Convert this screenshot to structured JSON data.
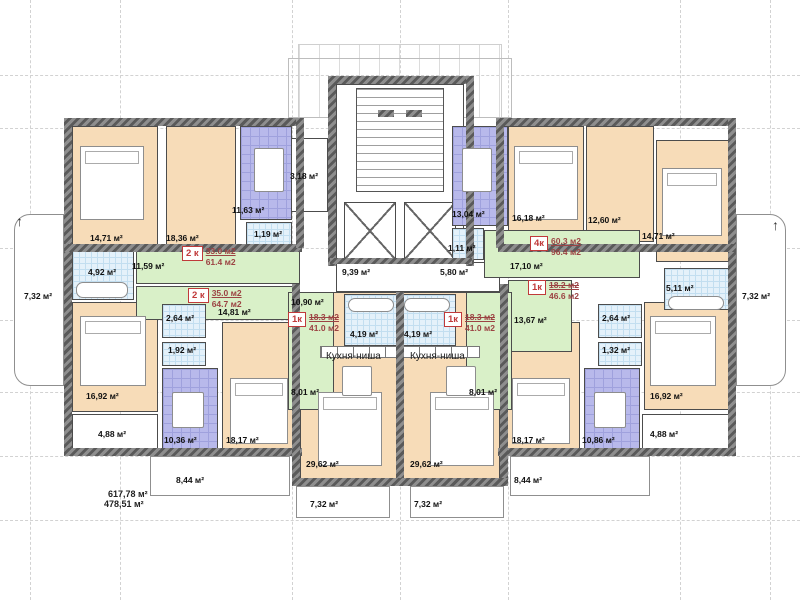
{
  "palette": {
    "room": "#f7dcb8",
    "kitchen": "#b8b9eb",
    "hall": "#d9f0c8",
    "bath": "#e4f1fa",
    "wall": "#5a5a5a",
    "badge_red": "#c03a3a",
    "badge_value": "#9c4343"
  },
  "grid": {
    "v": [
      30,
      120,
      292,
      400,
      508,
      680,
      770
    ],
    "h": [
      75,
      128,
      248,
      320,
      392,
      456,
      520
    ]
  },
  "regions": [
    {
      "name": "entrance-canopy-mullions",
      "f": "mull",
      "x": 298,
      "y": 44,
      "w": 204,
      "h": 74
    },
    {
      "name": "entrance-canopy-outline",
      "f": "out",
      "x": 288,
      "y": 58,
      "w": 224,
      "h": 60
    },
    {
      "name": "stairwell",
      "f": "white",
      "x": 336,
      "y": 84,
      "w": 128,
      "h": 176
    },
    {
      "name": "stairs",
      "f": "stairs",
      "x": 356,
      "y": 88,
      "w": 88,
      "h": 104
    },
    {
      "name": "elevator-left",
      "f": "lift",
      "x": 344,
      "y": 202,
      "w": 52,
      "h": 58
    },
    {
      "name": "elevator-right",
      "f": "lift",
      "x": 404,
      "y": 202,
      "w": 52,
      "h": 58
    },
    {
      "name": "elevator-lobby",
      "f": "white",
      "x": 336,
      "y": 262,
      "w": 164,
      "h": 30
    },
    {
      "name": "vestibule-318",
      "f": "white",
      "x": 288,
      "y": 138,
      "w": 40,
      "h": 74
    },
    {
      "name": "bedroom-1471-left",
      "f": "peach",
      "x": 72,
      "y": 126,
      "w": 86,
      "h": 122
    },
    {
      "name": "living-1836",
      "f": "peach",
      "x": 166,
      "y": 126,
      "w": 70,
      "h": 122
    },
    {
      "name": "bedroom-1692-left",
      "f": "peach",
      "x": 72,
      "y": 302,
      "w": 86,
      "h": 110
    },
    {
      "name": "bedroom-1817-left",
      "f": "peach",
      "x": 222,
      "y": 322,
      "w": 74,
      "h": 128
    },
    {
      "name": "bedroom-1618",
      "f": "peach",
      "x": 508,
      "y": 126,
      "w": 76,
      "h": 116
    },
    {
      "name": "bedroom-1260",
      "f": "peach",
      "x": 586,
      "y": 126,
      "w": 68,
      "h": 116
    },
    {
      "name": "bedroom-1471-right",
      "f": "peach",
      "x": 656,
      "y": 140,
      "w": 74,
      "h": 122
    },
    {
      "name": "bedroom-1692-right",
      "f": "peach",
      "x": 644,
      "y": 302,
      "w": 86,
      "h": 108
    },
    {
      "name": "bedroom-1817-right",
      "f": "peach",
      "x": 506,
      "y": 322,
      "w": 74,
      "h": 128
    },
    {
      "name": "living-2962-left",
      "f": "peach",
      "x": 300,
      "y": 292,
      "w": 98,
      "h": 192
    },
    {
      "name": "living-2962-right",
      "f": "peach",
      "x": 402,
      "y": 292,
      "w": 98,
      "h": 192
    },
    {
      "name": "hall-1159",
      "f": "green",
      "x": 136,
      "y": 250,
      "w": 164,
      "h": 34
    },
    {
      "name": "hall-1481",
      "f": "green",
      "x": 136,
      "y": 286,
      "w": 164,
      "h": 34
    },
    {
      "name": "hall-1710",
      "f": "green",
      "x": 484,
      "y": 230,
      "w": 156,
      "h": 48
    },
    {
      "name": "hall-1367",
      "f": "green",
      "x": 508,
      "y": 280,
      "w": 64,
      "h": 72
    },
    {
      "name": "hall-center-left",
      "f": "green",
      "x": 288,
      "y": 292,
      "w": 46,
      "h": 118
    },
    {
      "name": "hall-center-right",
      "f": "green",
      "x": 466,
      "y": 292,
      "w": 46,
      "h": 118
    },
    {
      "name": "kitchen-1163",
      "f": "blue",
      "x": 240,
      "y": 126,
      "w": 52,
      "h": 94
    },
    {
      "name": "kitchen-1036",
      "f": "blue",
      "x": 162,
      "y": 368,
      "w": 56,
      "h": 84
    },
    {
      "name": "kitchen-1304",
      "f": "blue",
      "x": 452,
      "y": 126,
      "w": 56,
      "h": 100
    },
    {
      "name": "kitchen-1086",
      "f": "blue",
      "x": 584,
      "y": 368,
      "w": 56,
      "h": 84
    },
    {
      "name": "bath-119",
      "f": "tile",
      "x": 246,
      "y": 222,
      "w": 46,
      "h": 28
    },
    {
      "name": "bath-492",
      "f": "tile",
      "x": 72,
      "y": 250,
      "w": 62,
      "h": 50
    },
    {
      "name": "wc-264-left",
      "f": "tile",
      "x": 162,
      "y": 304,
      "w": 44,
      "h": 34
    },
    {
      "name": "wc-192",
      "f": "tile",
      "x": 162,
      "y": 342,
      "w": 44,
      "h": 24
    },
    {
      "name": "bath-111",
      "f": "tile",
      "x": 452,
      "y": 228,
      "w": 32,
      "h": 32
    },
    {
      "name": "bath-419-left",
      "f": "tile",
      "x": 344,
      "y": 294,
      "w": 56,
      "h": 52
    },
    {
      "name": "bath-419-right",
      "f": "tile",
      "x": 400,
      "y": 294,
      "w": 56,
      "h": 52
    },
    {
      "name": "bath-511",
      "f": "tile",
      "x": 664,
      "y": 268,
      "w": 66,
      "h": 42
    },
    {
      "name": "wc-264-right",
      "f": "tile",
      "x": 598,
      "y": 304,
      "w": 44,
      "h": 34
    },
    {
      "name": "wc-132",
      "f": "tile",
      "x": 598,
      "y": 342,
      "w": 44,
      "h": 24
    },
    {
      "name": "loggia-488-left",
      "f": "white",
      "x": 72,
      "y": 414,
      "w": 86,
      "h": 38
    },
    {
      "name": "loggia-488-right",
      "f": "white",
      "x": 642,
      "y": 414,
      "w": 88,
      "h": 38
    },
    {
      "name": "balcony-side-left",
      "f": "balc",
      "x": 14,
      "y": 214,
      "w": 50,
      "h": 172,
      "r": "16px 0 0 16px"
    },
    {
      "name": "balcony-side-right",
      "f": "balc",
      "x": 736,
      "y": 214,
      "w": 50,
      "h": 172,
      "r": "0 16px 16px 0"
    },
    {
      "name": "balcony-844-left",
      "f": "balc",
      "x": 150,
      "y": 456,
      "w": 140,
      "h": 40
    },
    {
      "name": "balcony-844-right",
      "f": "balc",
      "x": 510,
      "y": 456,
      "w": 140,
      "h": 40
    },
    {
      "name": "balcony-732-left",
      "f": "balc",
      "x": 296,
      "y": 486,
      "w": 94,
      "h": 32
    },
    {
      "name": "balcony-732-right",
      "f": "balc",
      "x": 410,
      "y": 486,
      "w": 94,
      "h": 32
    },
    {
      "name": "kitchen-niche-counter-left",
      "f": "counter",
      "x": 320,
      "y": 346,
      "w": 78,
      "h": 12
    },
    {
      "name": "kitchen-niche-counter-right",
      "f": "counter",
      "x": 402,
      "y": 346,
      "w": 78,
      "h": 12
    }
  ],
  "walls": [
    {
      "x": 64,
      "y": 118,
      "w": 240,
      "h": 8
    },
    {
      "x": 496,
      "y": 118,
      "w": 240,
      "h": 8
    },
    {
      "x": 64,
      "y": 118,
      "w": 8,
      "h": 338
    },
    {
      "x": 728,
      "y": 118,
      "w": 8,
      "h": 338
    },
    {
      "x": 64,
      "y": 448,
      "w": 238,
      "h": 8
    },
    {
      "x": 498,
      "y": 448,
      "w": 238,
      "h": 8
    },
    {
      "x": 64,
      "y": 244,
      "w": 238,
      "h": 8
    },
    {
      "x": 498,
      "y": 244,
      "w": 238,
      "h": 8
    },
    {
      "x": 328,
      "y": 76,
      "w": 146,
      "h": 8
    },
    {
      "x": 328,
      "y": 76,
      "w": 8,
      "h": 190
    },
    {
      "x": 466,
      "y": 76,
      "w": 8,
      "h": 190
    },
    {
      "x": 330,
      "y": 258,
      "w": 142,
      "h": 6
    },
    {
      "x": 292,
      "y": 284,
      "w": 8,
      "h": 202
    },
    {
      "x": 500,
      "y": 284,
      "w": 8,
      "h": 202
    },
    {
      "x": 396,
      "y": 292,
      "w": 8,
      "h": 194
    },
    {
      "x": 292,
      "y": 478,
      "w": 216,
      "h": 8
    },
    {
      "x": 296,
      "y": 118,
      "w": 8,
      "h": 130
    },
    {
      "x": 496,
      "y": 118,
      "w": 8,
      "h": 130
    },
    {
      "x": 378,
      "y": 110,
      "w": 16,
      "h": 7
    },
    {
      "x": 406,
      "y": 110,
      "w": 16,
      "h": 7
    }
  ],
  "furniture": [
    {
      "t": "bed",
      "x": 80,
      "y": 146,
      "w": 64,
      "h": 74
    },
    {
      "t": "bed",
      "x": 80,
      "y": 316,
      "w": 66,
      "h": 70
    },
    {
      "t": "bed",
      "x": 230,
      "y": 378,
      "w": 58,
      "h": 66
    },
    {
      "t": "bed",
      "x": 514,
      "y": 146,
      "w": 64,
      "h": 74
    },
    {
      "t": "bed",
      "x": 662,
      "y": 168,
      "w": 60,
      "h": 68
    },
    {
      "t": "bed",
      "x": 650,
      "y": 316,
      "w": 66,
      "h": 70
    },
    {
      "t": "bed",
      "x": 512,
      "y": 378,
      "w": 58,
      "h": 66
    },
    {
      "t": "bed",
      "x": 318,
      "y": 392,
      "w": 64,
      "h": 74
    },
    {
      "t": "bed",
      "x": 430,
      "y": 392,
      "w": 64,
      "h": 74
    },
    {
      "t": "table",
      "x": 254,
      "y": 148,
      "w": 30,
      "h": 44
    },
    {
      "t": "table",
      "x": 462,
      "y": 148,
      "w": 30,
      "h": 44
    },
    {
      "t": "table",
      "x": 172,
      "y": 392,
      "w": 32,
      "h": 36
    },
    {
      "t": "table",
      "x": 594,
      "y": 392,
      "w": 32,
      "h": 36
    },
    {
      "t": "table",
      "x": 342,
      "y": 366,
      "w": 30,
      "h": 30
    },
    {
      "t": "table",
      "x": 446,
      "y": 366,
      "w": 30,
      "h": 30
    },
    {
      "t": "tub",
      "x": 76,
      "y": 282,
      "w": 52,
      "h": 16
    },
    {
      "t": "tub",
      "x": 668,
      "y": 296,
      "w": 56,
      "h": 14
    },
    {
      "t": "tub",
      "x": 348,
      "y": 298,
      "w": 46,
      "h": 14
    },
    {
      "t": "tub",
      "x": 404,
      "y": 298,
      "w": 46,
      "h": 14
    }
  ],
  "labels": [
    {
      "t": "14,71 м²",
      "x": 90,
      "y": 234
    },
    {
      "t": "18,36 м²",
      "x": 166,
      "y": 234
    },
    {
      "t": "11,63 м²",
      "x": 232,
      "y": 206
    },
    {
      "t": "1,19 м²",
      "x": 254,
      "y": 230
    },
    {
      "t": "11,59 м²",
      "x": 132,
      "y": 262
    },
    {
      "t": "4,92 м²",
      "x": 88,
      "y": 268
    },
    {
      "t": "14,81 м²",
      "x": 218,
      "y": 308
    },
    {
      "t": "2,64 м²",
      "x": 166,
      "y": 314
    },
    {
      "t": "1,92 м²",
      "x": 168,
      "y": 346
    },
    {
      "t": "16,92 м²",
      "x": 86,
      "y": 392
    },
    {
      "t": "10,36 м²",
      "x": 164,
      "y": 436
    },
    {
      "t": "18,17 м²",
      "x": 226,
      "y": 436
    },
    {
      "t": "4,88 м²",
      "x": 98,
      "y": 430
    },
    {
      "t": "3,18 м²",
      "x": 290,
      "y": 172
    },
    {
      "t": "13,04 м²",
      "x": 452,
      "y": 210
    },
    {
      "t": "1,11 м²",
      "x": 448,
      "y": 244
    },
    {
      "t": "9,39 м²",
      "x": 342,
      "y": 268
    },
    {
      "t": "5,80 м²",
      "x": 440,
      "y": 268
    },
    {
      "t": "17,10 м²",
      "x": 510,
      "y": 262
    },
    {
      "t": "13,67 м²",
      "x": 514,
      "y": 316
    },
    {
      "t": "10,90 м²",
      "x": 291,
      "y": 298
    },
    {
      "t": "4,19 м²",
      "x": 350,
      "y": 330
    },
    {
      "t": "4,19 м²",
      "x": 404,
      "y": 330
    },
    {
      "t": "Кухня-ниша",
      "x": 326,
      "y": 352,
      "c": "niche"
    },
    {
      "t": "Кухня-ниша",
      "x": 410,
      "y": 352,
      "c": "niche"
    },
    {
      "t": "8,01 м²",
      "x": 291,
      "y": 388
    },
    {
      "t": "8,01 м²",
      "x": 469,
      "y": 388
    },
    {
      "t": "29,62 м²",
      "x": 306,
      "y": 460
    },
    {
      "t": "29,62 м²",
      "x": 410,
      "y": 460
    },
    {
      "t": "7,32 м²",
      "x": 310,
      "y": 500
    },
    {
      "t": "7,32 м²",
      "x": 414,
      "y": 500
    },
    {
      "t": "16,18 м²",
      "x": 512,
      "y": 214
    },
    {
      "t": "12,60 м²",
      "x": 588,
      "y": 216
    },
    {
      "t": "14,71 м²",
      "x": 642,
      "y": 232
    },
    {
      "t": "5,11 м²",
      "x": 666,
      "y": 284
    },
    {
      "t": "2,64 м²",
      "x": 602,
      "y": 314
    },
    {
      "t": "1,32 м²",
      "x": 602,
      "y": 346
    },
    {
      "t": "16,92 м²",
      "x": 650,
      "y": 392
    },
    {
      "t": "10,86 м²",
      "x": 582,
      "y": 436
    },
    {
      "t": "18,17 м²",
      "x": 512,
      "y": 436
    },
    {
      "t": "4,88 м²",
      "x": 650,
      "y": 430
    },
    {
      "t": "7,32 м²",
      "x": 24,
      "y": 292
    },
    {
      "t": "7,32 м²",
      "x": 742,
      "y": 292
    },
    {
      "t": "8,44 м²",
      "x": 176,
      "y": 476
    },
    {
      "t": "8,44 м²",
      "x": 514,
      "y": 476
    },
    {
      "t": "617,78 м²",
      "x": 108,
      "y": 490,
      "c": "total"
    },
    {
      "t": "478,51 м²",
      "x": 104,
      "y": 500,
      "c": "total"
    },
    {
      "t": "↑",
      "x": 16,
      "y": 214,
      "c": "arrow"
    },
    {
      "t": "↑",
      "x": 772,
      "y": 218,
      "c": "arrow"
    }
  ],
  "apartment_badges": [
    {
      "code": "2 к",
      "living": "33.0 м2",
      "total": "61.4 м2",
      "x": 182,
      "y": 246,
      "struck": false
    },
    {
      "code": "2 к",
      "living": "35.0 м2",
      "total": "64.7 м2",
      "x": 188,
      "y": 288,
      "struck": false
    },
    {
      "code": "1к",
      "living": "18.3 м2",
      "total": "41.0 м2",
      "x": 288,
      "y": 312,
      "struck": true
    },
    {
      "code": "1к",
      "living": "18.3 м2",
      "total": "41.0 м2",
      "x": 444,
      "y": 312,
      "struck": true
    },
    {
      "code": "4к",
      "living": "60.3 м2",
      "total": "96.4 м2",
      "x": 530,
      "y": 236,
      "struck": false
    },
    {
      "code": "1к",
      "living": "18.2 м2",
      "total": "46.6 м2",
      "x": 528,
      "y": 280,
      "struck": true
    }
  ]
}
